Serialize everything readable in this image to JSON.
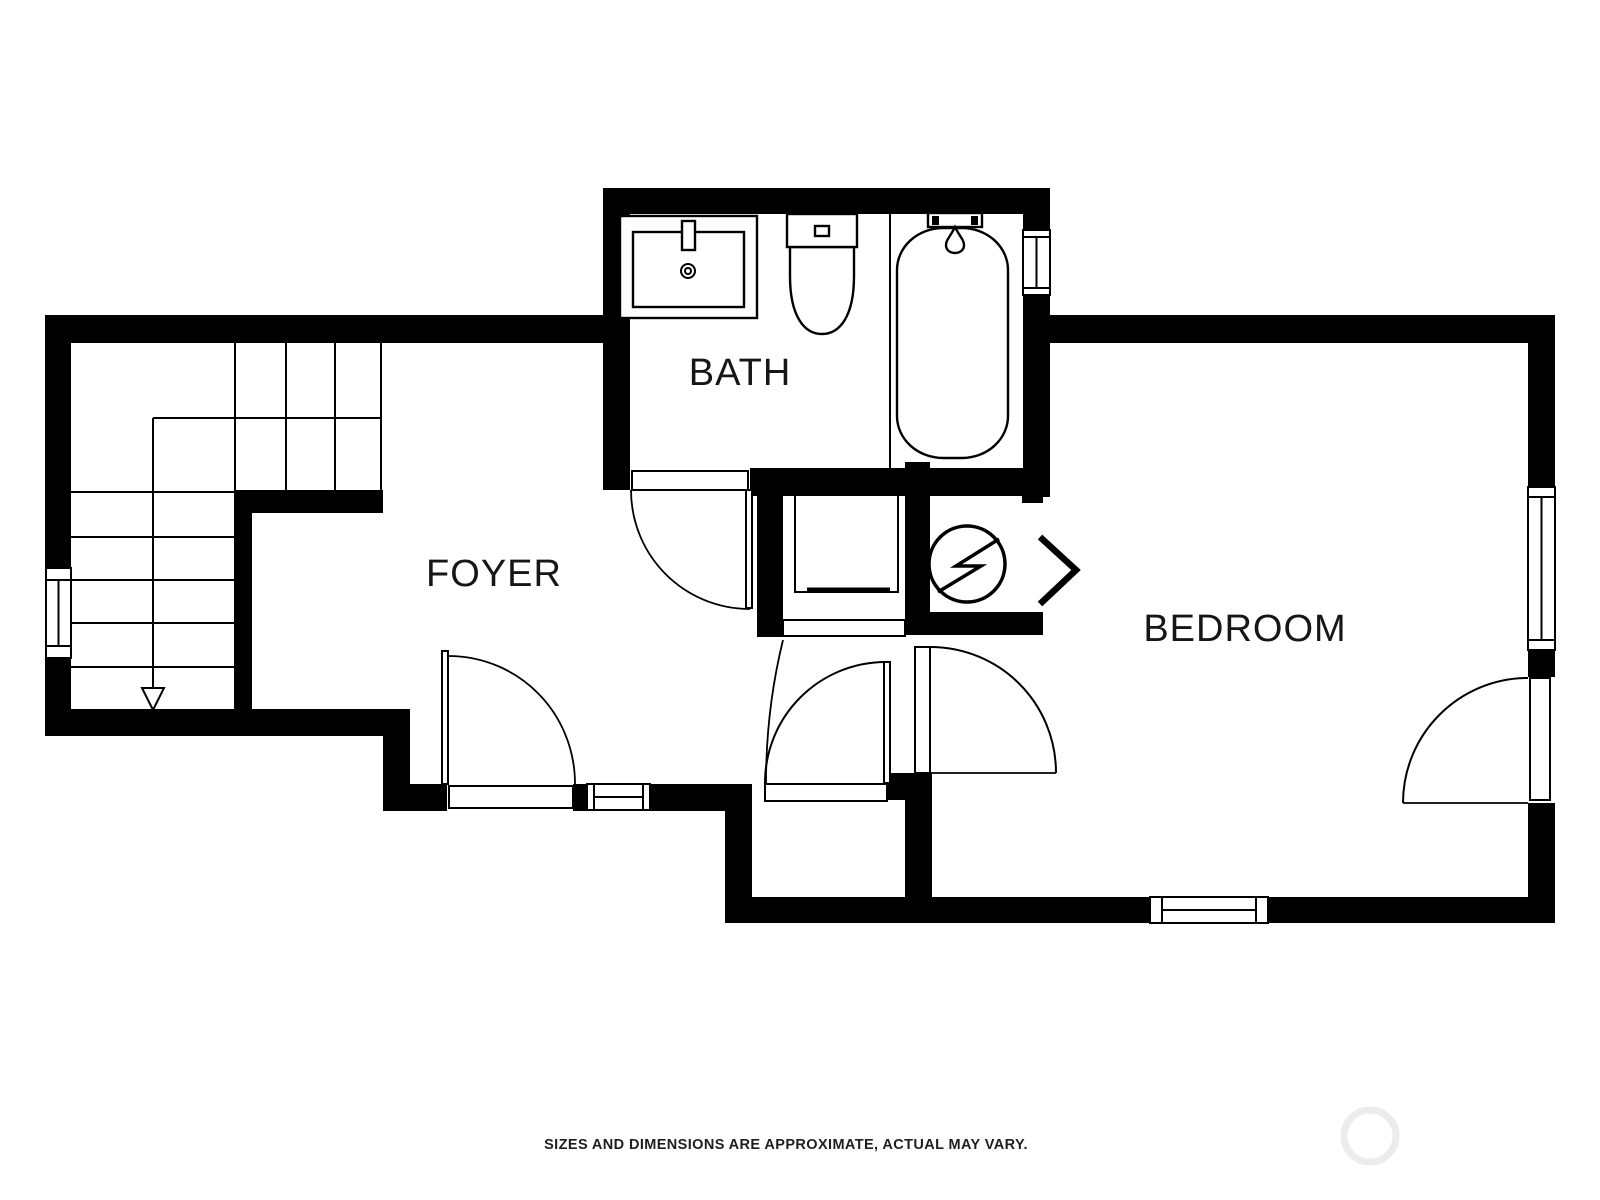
{
  "floorplan": {
    "rooms": [
      {
        "label": "BATH"
      },
      {
        "label": "FOYER"
      },
      {
        "label": "BEDROOM"
      }
    ],
    "caption": "SIZES AND DIMENSIONS ARE APPROXIMATE, ACTUAL MAY VARY.",
    "colors": {
      "walls": "#000000",
      "background": "#ffffff",
      "text": "#161616",
      "watermark": "#ececec"
    },
    "fixtures": [
      "sink-vanity",
      "toilet",
      "bathtub"
    ],
    "stairs": {
      "direction": "down",
      "lower_treads": 5,
      "winder_columns": 3
    },
    "symbols": {
      "utility": "water-heater-icon",
      "access_arrow": "chevron-right-icon",
      "stair_arrow": "down-arrow-icon"
    },
    "counts": {
      "windows": 5,
      "door_swings": 5,
      "closet_sliders": 1
    }
  }
}
